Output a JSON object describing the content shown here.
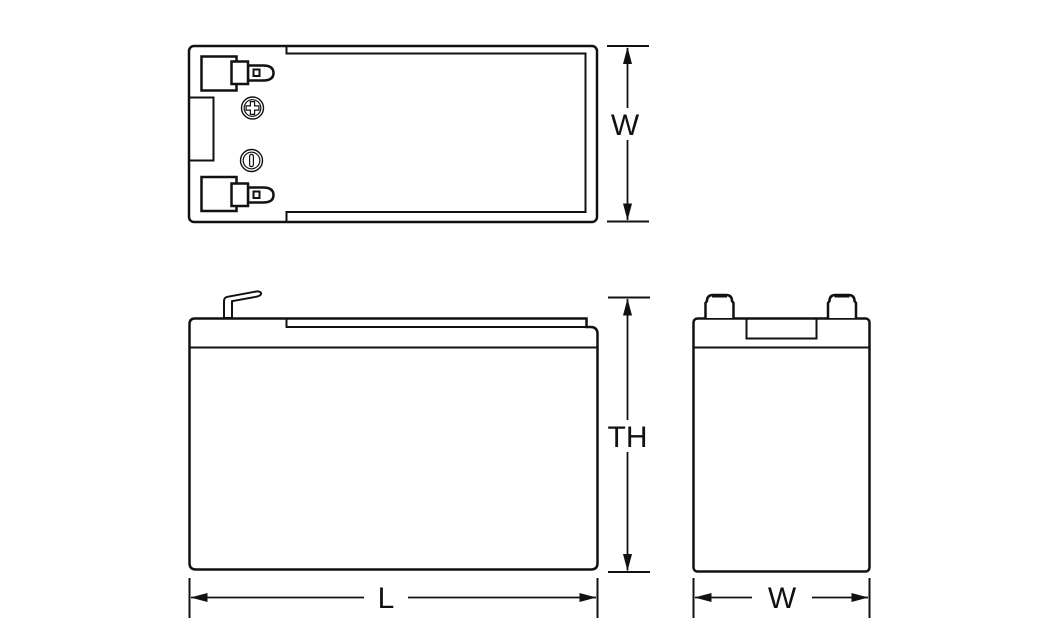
{
  "labels": {
    "top_view_width": "W",
    "side_view_total_height": "TH",
    "side_view_length": "L",
    "end_view_width": "W"
  },
  "colors": {
    "background": "#ffffff",
    "line": "#111111",
    "positive_terminal": "#ce2d26",
    "negative_terminal": "#111111"
  },
  "markers": {
    "positive": "plus-in-circle",
    "negative": "minus-bar-in-circle"
  }
}
